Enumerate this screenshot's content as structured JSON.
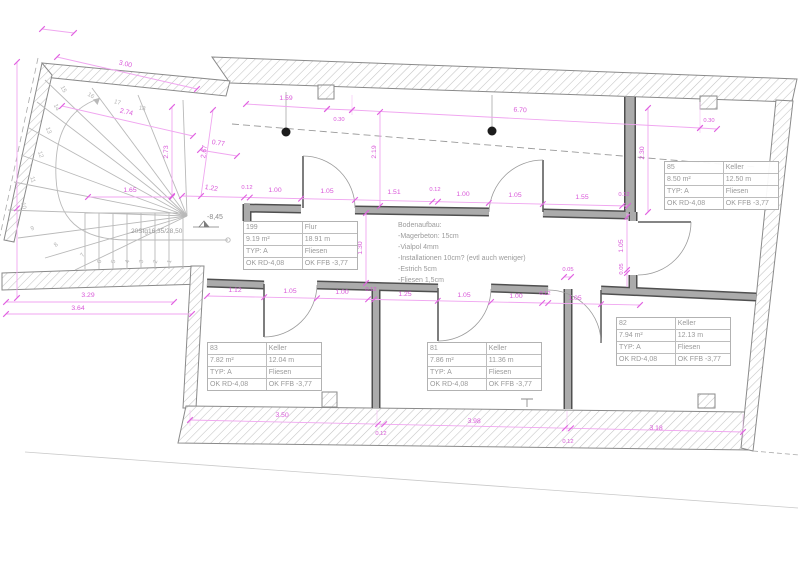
{
  "rooms": [
    {
      "number": "199",
      "name": "Flur",
      "area": "9.19 m²",
      "perimeter": "18.91 m",
      "type": "TYP: A",
      "floor": "Fliesen",
      "ok_rd": "OK RD-4,08",
      "ok_ffb": "OK FFB -3,77"
    },
    {
      "number": "85",
      "name": "Keller",
      "area": "8.50 m²",
      "perimeter": "12.50 m",
      "type": "TYP: A",
      "floor": "Fliesen",
      "ok_rd": "OK RD-4,08",
      "ok_ffb": "OK FFB -3,77"
    },
    {
      "number": "83",
      "name": "Keller",
      "area": "7.82 m²",
      "perimeter": "12.04 m",
      "type": "TYP: A",
      "floor": "Fliesen",
      "ok_rd": "OK RD-4,08",
      "ok_ffb": "OK FFB -3,77"
    },
    {
      "number": "81",
      "name": "Keller",
      "area": "7.86 m²",
      "perimeter": "11.36 m",
      "type": "TYP: A",
      "floor": "Fliesen",
      "ok_rd": "OK RD-4,08",
      "ok_ffb": "OK FFB -3,77"
    },
    {
      "number": "82",
      "name": "Keller",
      "area": "7.94 m²",
      "perimeter": "12.13 m",
      "type": "TYP: A",
      "floor": "Fliesen",
      "ok_rd": "OK RD-4,08",
      "ok_ffb": "OK FFB -3,77"
    }
  ],
  "floor_note": {
    "title": "Bodenaufbau:",
    "lines": [
      "-Magerbeton: 15cm",
      "-Vialpol 4mm",
      "-Installationen 10cm? (evtl auch weniger)",
      "-Estrich 5cm",
      "-Fliesen 1,5cm"
    ]
  },
  "stair": {
    "label": "20Stg16,35/28,50",
    "numbers": [
      "1",
      "2",
      "3",
      "4",
      "5",
      "6",
      "7",
      "8",
      "9",
      "10",
      "11",
      "12",
      "13",
      "14",
      "15",
      "16",
      "17",
      "18"
    ]
  },
  "level_marker": "-8,45",
  "dims": {
    "stair_top": "3.00",
    "stair_top2": "2.74",
    "stair_w1": "0.77",
    "stair_v1": "2.73",
    "stair_v2": "2.67",
    "stair_h1": "1.65",
    "stair_slant": "1.22",
    "stair_b1": "3.29",
    "stair_b2": "3.64",
    "top1": "1.59",
    "top2": "0.30",
    "top3": "6.70",
    "top4": "0.30",
    "upper_v1": "2.19",
    "upper_v2": "2.30",
    "ct": [
      "0.12",
      "1.00",
      "1.05",
      "1.51",
      "0.12",
      "1.00",
      "1.05",
      "1.55",
      "0.12"
    ],
    "corridor_w": "1.30",
    "cb": [
      "1.12",
      "1.05",
      "1.00",
      "0.12",
      "1.25",
      "1.05",
      "1.00",
      "0.12",
      "1.05"
    ],
    "d85_1": "1.05",
    "d85_2": "0.05",
    "d85_3": "0.05",
    "bottom": [
      "3.50",
      "0.12",
      "3.98",
      "0.12",
      "3.18"
    ]
  },
  "colors": {
    "dimension": "#D958D9",
    "dimension_line": "#F0A6F0",
    "wall_fill": "#ABABAB",
    "wall_edge": "#4F4F4F",
    "hatch": "#C3C3C3",
    "annotation": "#9B9B9B"
  }
}
